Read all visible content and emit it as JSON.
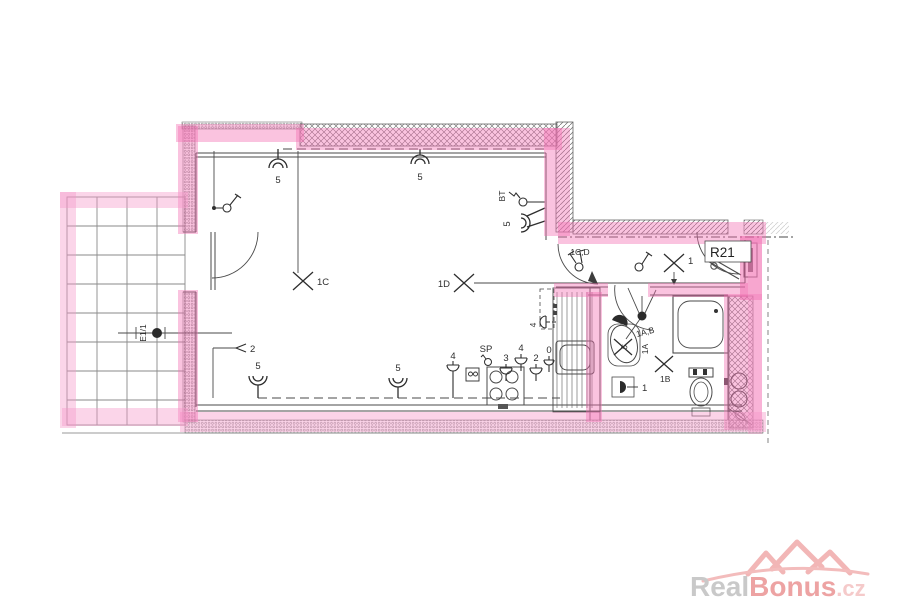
{
  "plan": {
    "room_label": "R21",
    "terrace_light_label": "E1/1",
    "wall_light_label": "5",
    "ceiling_lights": {
      "c1c": "1C",
      "c1d": "1D",
      "c1": "1",
      "c1a": "1A",
      "c1b": "1B"
    },
    "switch_labels": {
      "cd": "1C,D",
      "ab": "1A,B",
      "bt": "BT"
    },
    "socket_labels": {
      "s0": "0",
      "s1": "1",
      "s2": "2",
      "s3": "3",
      "s4": "4",
      "sp": "SP"
    }
  },
  "watermark": {
    "brand_gray": "Real",
    "brand_pink": "Bonus",
    "brand_tld": ".cz"
  },
  "colors": {
    "highlight": "#f06fb0",
    "ink": "#3d3d3d",
    "watermark_gray": "#c9c9c9",
    "watermark_pink": "#eda3a3"
  }
}
